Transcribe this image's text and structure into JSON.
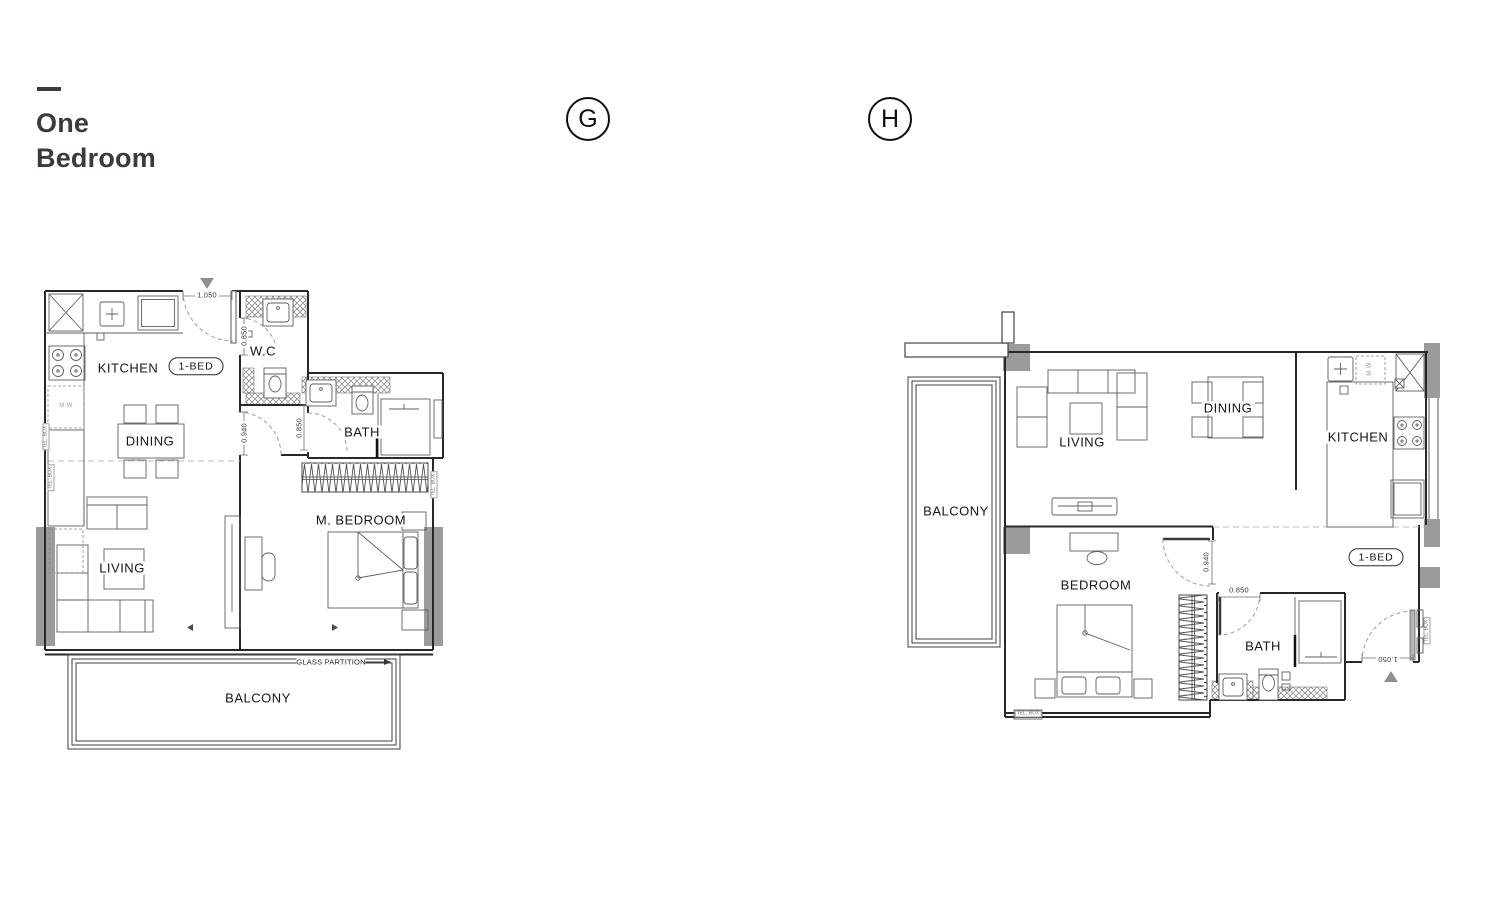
{
  "page": {
    "title_line1": "One",
    "title_line2": "Bedroom"
  },
  "plans": {
    "g": {
      "badge": "G",
      "unit_tag": "1-BED",
      "rooms": {
        "kitchen": "KITCHEN",
        "wc": "W.C",
        "dining": "DINING",
        "bath": "BATH",
        "living": "LIVING",
        "master_bedroom": "M. BEDROOM",
        "balcony": "BALCONY"
      },
      "dims": {
        "entry_width": "1.050",
        "wc_door": "0.850",
        "hall_width": "0.940",
        "bath_door": "0.850"
      },
      "notes": {
        "glass_partition": "GLASS PARTITION",
        "microwave": "M.W",
        "tel_box": "TEL. BOX"
      }
    },
    "h": {
      "badge": "H",
      "unit_tag": "1-BED",
      "rooms": {
        "balcony": "BALCONY",
        "living": "LIVING",
        "dining": "DINING",
        "kitchen": "KITCHEN",
        "bedroom": "BEDROOM",
        "bath": "BATH"
      },
      "dims": {
        "hall_width": "0.940",
        "bath_door": "0.850",
        "entry_width": "1.050"
      },
      "notes": {
        "microwave": "M W",
        "tel_box": "TEL. BOX"
      }
    }
  },
  "colors": {
    "wall_line": "#2a2a2a",
    "furniture_line": "#5f5f5f",
    "pier_gray": "#9b9b9b",
    "title_text": "#3e3a37"
  }
}
